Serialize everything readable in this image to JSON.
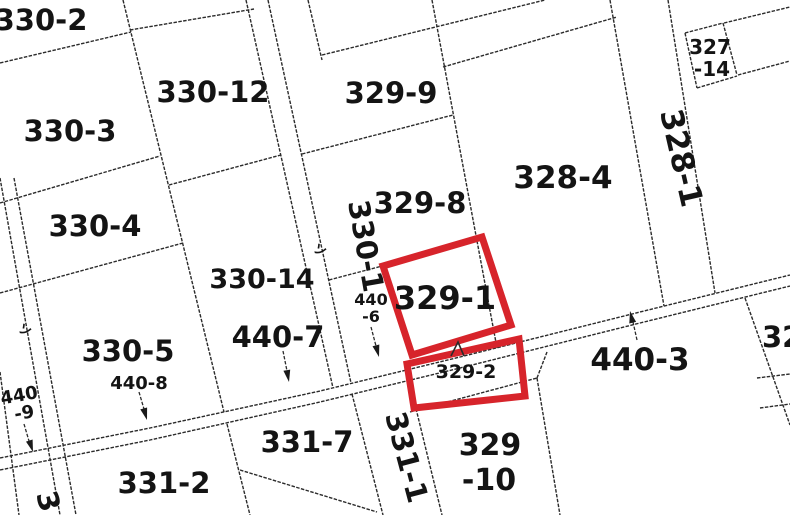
{
  "map": {
    "type": "cadastral-parcel-map",
    "background": "#ffffff",
    "line_color": "#2b2b2b",
    "text_color": "#141414",
    "highlight_color": "#d7242b",
    "highlighted_parcels": [
      "329-1",
      "329-2"
    ],
    "labels": {
      "l330_2": "330-2",
      "l330_12": "330-12",
      "l329_9": "329-9",
      "l327_14_line1": "327",
      "l327_14_line2": "-14",
      "l328_4": "328-4",
      "l328_1": "328-1",
      "l330_3": "330-3",
      "l330_4": "330-4",
      "l329_8": "329-8",
      "l330_1": "330-1",
      "l330_14": "330-14",
      "l440_7": "440-7",
      "l330_5": "330-5",
      "l440_8": "440-8",
      "l440_9_line1": "440",
      "l440_9_line2": "-9",
      "l440_6_line1": "440",
      "l440_6_line2": "-6",
      "l329_1": "329-1",
      "l329_2": "329-2",
      "l440_3": "440-3",
      "l331_7": "331-7",
      "l331_1": "331-1",
      "l329_10_line1": "329",
      "l329_10_line2": "-10",
      "l331_2": "331-2",
      "l3_partial": "3",
      "l32_partial": "32",
      "tick_mark_left": "ソ",
      "tick_mark_center": "ソ"
    }
  }
}
